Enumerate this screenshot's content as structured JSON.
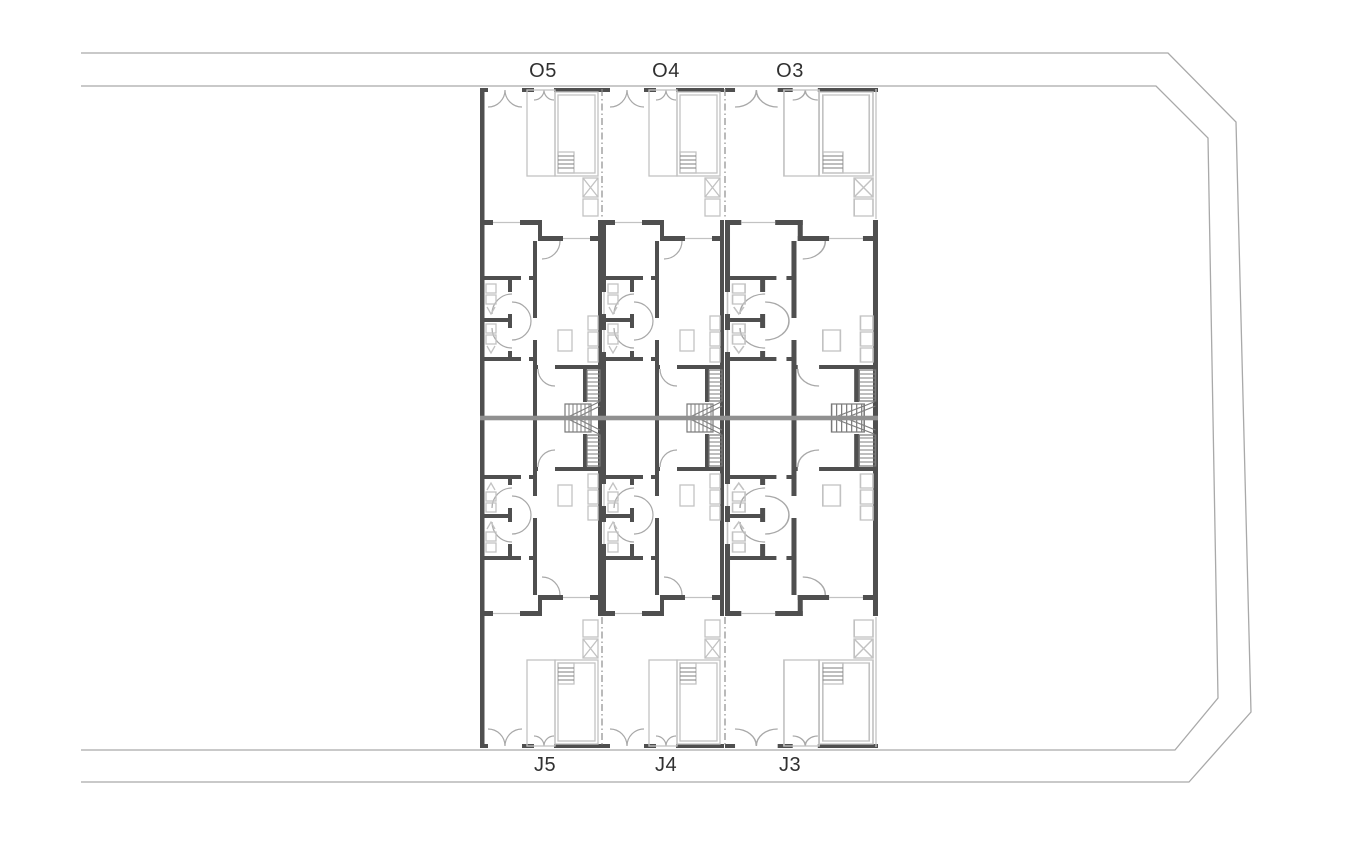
{
  "plan": {
    "top_row_units": [
      {
        "label": "O5"
      },
      {
        "label": "O4"
      },
      {
        "label": "O3"
      }
    ],
    "bottom_row_units": [
      {
        "label": "J5"
      },
      {
        "label": "J4"
      },
      {
        "label": "J3"
      }
    ]
  },
  "colors": {
    "background": "#ffffff",
    "wall": "#4f4f4f",
    "party_wall": "#909090",
    "furniture": "#c2c2c2",
    "door_arc": "#a8a8a8",
    "site_boundary": "#a9a9a9",
    "label": "#303030"
  }
}
